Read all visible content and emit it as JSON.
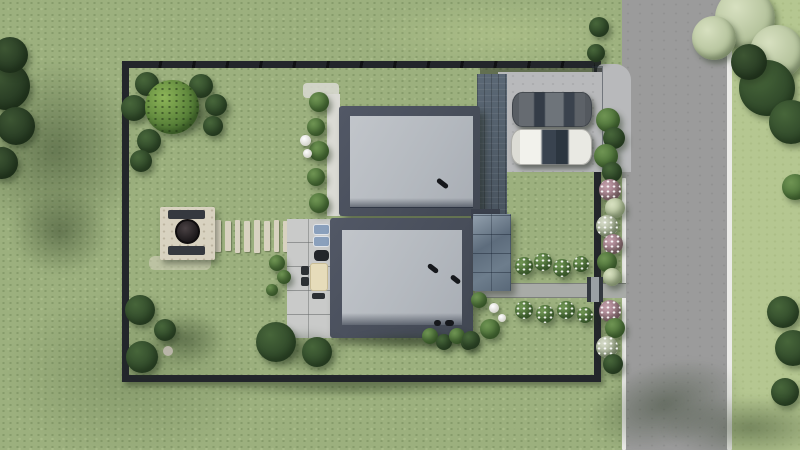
{
  "scene": {
    "type": "aerial-3d-architectural-render",
    "view": "top-down",
    "description": "Photorealistic top-down visualization of a fenced residential plot: two modern flat-roof houses joined as a duplex, a concrete parking pad with two parked cars, a glass canopy, a terrace with outdoor furniture, a fire-pit patio with benches, a stepping-stone path, garden beds and hedges, lawns all around, and a vertical asphalt road with white edge lines on the right.",
    "objects": {
      "houses": 2,
      "parked_cars": 2,
      "car_colors": [
        "dark gray",
        "white"
      ],
      "roof_vents": 4,
      "garden_lamps": 4,
      "stepping_stones": 8,
      "features": [
        "perimeter fence",
        "driveway entrance from road",
        "parking pad",
        "dark paver strip",
        "glass canopy",
        "terrace with lounge, grill, dining table and chairs",
        "fire pit patio with two benches",
        "stepping stone path",
        "flower beds along walkway",
        "hedge and flower strip along street fence",
        "ornamental trees and shrubs",
        "asphalt road with white edge lines",
        "tree shadows on lawn and road"
      ]
    }
  },
  "palette": {
    "lawn": "#9cb07e",
    "lawn_east": "#b5c791",
    "road": "#9b9b9b",
    "road_line": "#ebebe8",
    "fence": "#23262b",
    "parapet": "#4a505c",
    "roof": "#b9bdc3",
    "parking": "#b8b9bb",
    "pavers": "#525f6d",
    "canopy_light": "#8e9caa",
    "canopy_dark": "#5a6979",
    "terrace": "#c9cac9",
    "path": "#a8aba7",
    "stone": "#d8d2c0",
    "bench": "#35393f",
    "fire_bowl": "#1e1a1c",
    "car_dark": "#565b61",
    "car_white": "#e9e9e5",
    "glass": "#2f3a47",
    "table": "#e6dcba",
    "chair": "#2c3034",
    "cushion": "#8aa0bc",
    "bush_dark": "#3c5a33",
    "bush_mid": "#557a3f",
    "bush_bright": "#76a348",
    "tree_sage": "#c9d5b2",
    "flower_pink": "#b38d99",
    "flower_white": "#dfe3da",
    "lamp": "#f1f1ec"
  }
}
